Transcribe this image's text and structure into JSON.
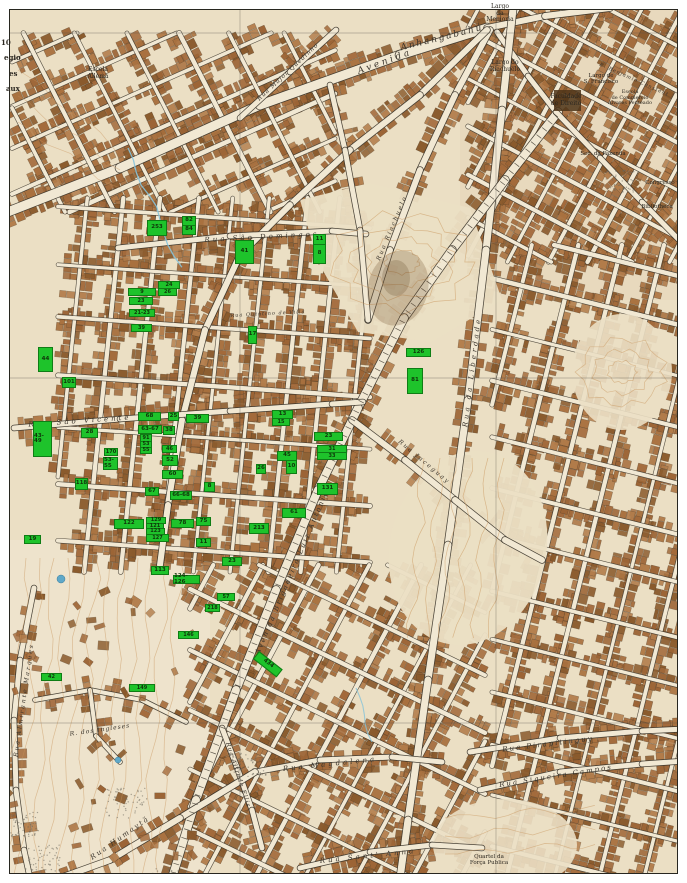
{
  "map_type": "historical-city-plan",
  "city_area": "São Paulo - Anhangabahú / Liberdade / Bexiga",
  "colors": {
    "paper": "#ebdfc4",
    "paper_light": "#f1e8d3",
    "building": "#a9713f",
    "building_dark": "#8a5a2c",
    "street_ink": "#3a342a",
    "street_fill": "#f1e8d3",
    "marker_green": "#1ec32b",
    "marker_text": "#10350a",
    "contour": "#c8935a",
    "water": "#6fb3cf",
    "label_ink": "#3a342c",
    "grid": "#55524a",
    "frame": "#27261f"
  },
  "markers": [
    {
      "t": "253",
      "x": 147,
      "y": 220,
      "w": 18,
      "h": 14
    },
    {
      "t": "82",
      "x": 182,
      "y": 216,
      "w": 12,
      "h": 8
    },
    {
      "t": "84",
      "x": 182,
      "y": 225,
      "w": 12,
      "h": 8
    },
    {
      "t": "41",
      "x": 235,
      "y": 240,
      "w": 17,
      "h": 22
    },
    {
      "t": "11",
      "x": 313,
      "y": 234,
      "w": 11,
      "h": 9
    },
    {
      "t": "8",
      "x": 313,
      "y": 244,
      "w": 11,
      "h": 18
    },
    {
      "t": "24",
      "x": 158,
      "y": 281,
      "w": 20,
      "h": 6
    },
    {
      "t": "26",
      "x": 158,
      "y": 288,
      "w": 17,
      "h": 6
    },
    {
      "t": "9",
      "x": 128,
      "y": 288,
      "w": 26,
      "h": 6
    },
    {
      "t": "23",
      "x": 129,
      "y": 297,
      "w": 22,
      "h": 6
    },
    {
      "t": "21-23",
      "x": 129,
      "y": 309,
      "w": 24,
      "h": 6
    },
    {
      "t": "39",
      "x": 131,
      "y": 324,
      "w": 19,
      "h": 6
    },
    {
      "t": "17",
      "x": 248,
      "y": 326,
      "w": 7,
      "h": 16
    },
    {
      "t": "126",
      "x": 406,
      "y": 348,
      "w": 23,
      "h": 7
    },
    {
      "t": "81",
      "x": 407,
      "y": 368,
      "w": 14,
      "h": 24
    },
    {
      "t": "44",
      "x": 38,
      "y": 347,
      "w": 13,
      "h": 23
    },
    {
      "t": "101",
      "x": 62,
      "y": 377,
      "w": 12,
      "h": 9
    },
    {
      "t": "68",
      "x": 138,
      "y": 412,
      "w": 21,
      "h": 7
    },
    {
      "t": "25",
      "x": 168,
      "y": 412,
      "w": 9,
      "h": 7
    },
    {
      "t": "39",
      "x": 186,
      "y": 414,
      "w": 21,
      "h": 7
    },
    {
      "t": "63-67",
      "x": 138,
      "y": 425,
      "w": 22,
      "h": 7
    },
    {
      "t": "38",
      "x": 163,
      "y": 426,
      "w": 10,
      "h": 7
    },
    {
      "t": "91",
      "x": 140,
      "y": 434,
      "w": 10,
      "h": 6
    },
    {
      "t": "53",
      "x": 140,
      "y": 441,
      "w": 10,
      "h": 5
    },
    {
      "t": "55",
      "x": 140,
      "y": 447,
      "w": 10,
      "h": 5
    },
    {
      "t": "46",
      "x": 162,
      "y": 445,
      "w": 13,
      "h": 6
    },
    {
      "t": "43-49",
      "x": 33,
      "y": 421,
      "w": 17,
      "h": 34
    },
    {
      "t": "28",
      "x": 81,
      "y": 428,
      "w": 15,
      "h": 8
    },
    {
      "t": "170",
      "x": 104,
      "y": 448,
      "w": 12,
      "h": 6
    },
    {
      "t": "53-55",
      "x": 103,
      "y": 457,
      "w": 13,
      "h": 11
    },
    {
      "t": "52",
      "x": 162,
      "y": 455,
      "w": 14,
      "h": 9
    },
    {
      "t": "60",
      "x": 162,
      "y": 470,
      "w": 19,
      "h": 7
    },
    {
      "t": "118",
      "x": 75,
      "y": 478,
      "w": 11,
      "h": 10
    },
    {
      "t": "67",
      "x": 145,
      "y": 487,
      "w": 12,
      "h": 7
    },
    {
      "t": "66-68",
      "x": 170,
      "y": 491,
      "w": 20,
      "h": 7
    },
    {
      "t": "8",
      "x": 204,
      "y": 482,
      "w": 9,
      "h": 8
    },
    {
      "t": "13",
      "x": 272,
      "y": 410,
      "w": 19,
      "h": 7
    },
    {
      "t": "15",
      "x": 272,
      "y": 418,
      "w": 16,
      "h": 6
    },
    {
      "t": "23",
      "x": 314,
      "y": 432,
      "w": 27,
      "h": 7
    },
    {
      "t": "31",
      "x": 317,
      "y": 445,
      "w": 28,
      "h": 6
    },
    {
      "t": "33",
      "x": 317,
      "y": 452,
      "w": 28,
      "h": 6
    },
    {
      "t": "45",
      "x": 277,
      "y": 451,
      "w": 18,
      "h": 8
    },
    {
      "t": "10",
      "x": 286,
      "y": 460,
      "w": 9,
      "h": 12
    },
    {
      "t": "26",
      "x": 256,
      "y": 464,
      "w": 8,
      "h": 8
    },
    {
      "t": "131",
      "x": 317,
      "y": 483,
      "w": 19,
      "h": 10
    },
    {
      "t": "61",
      "x": 282,
      "y": 508,
      "w": 22,
      "h": 8
    },
    {
      "t": "213",
      "x": 249,
      "y": 523,
      "w": 18,
      "h": 9
    },
    {
      "t": "122",
      "x": 114,
      "y": 519,
      "w": 28,
      "h": 8
    },
    {
      "t": "129",
      "x": 146,
      "y": 517,
      "w": 18,
      "h": 5
    },
    {
      "t": "121",
      "x": 146,
      "y": 523,
      "w": 16,
      "h": 5
    },
    {
      "t": "123",
      "x": 146,
      "y": 528,
      "w": 17,
      "h": 5
    },
    {
      "t": "78",
      "x": 171,
      "y": 519,
      "w": 21,
      "h": 7
    },
    {
      "t": "75",
      "x": 196,
      "y": 517,
      "w": 13,
      "h": 7
    },
    {
      "t": "127",
      "x": 146,
      "y": 534,
      "w": 21,
      "h": 6
    },
    {
      "t": "11",
      "x": 196,
      "y": 538,
      "w": 13,
      "h": 7
    },
    {
      "t": "19",
      "x": 24,
      "y": 535,
      "w": 15,
      "h": 7
    },
    {
      "t": "23",
      "x": 222,
      "y": 557,
      "w": 18,
      "h": 7
    },
    {
      "t": "113",
      "x": 151,
      "y": 566,
      "w": 16,
      "h": 7
    },
    {
      "t": "124-126",
      "x": 173,
      "y": 575,
      "w": 25,
      "h": 7
    },
    {
      "t": "57",
      "x": 217,
      "y": 593,
      "w": 16,
      "h": 6
    },
    {
      "t": "218",
      "x": 205,
      "y": 604,
      "w": 13,
      "h": 6
    },
    {
      "t": "146",
      "x": 178,
      "y": 631,
      "w": 19,
      "h": 6
    },
    {
      "t": "149",
      "x": 129,
      "y": 684,
      "w": 24,
      "h": 6
    },
    {
      "t": "434",
      "x": 256,
      "y": 650,
      "w": 28,
      "h": 8,
      "r": 38
    },
    {
      "t": "42",
      "x": 41,
      "y": 673,
      "w": 19,
      "h": 6
    }
  ],
  "street_labels": [
    {
      "t": "Avenida",
      "x": 385,
      "y": 62,
      "r": -20,
      "s": 9,
      "ls": 3
    },
    {
      "t": "Anhangabahú",
      "x": 442,
      "y": 38,
      "r": -14,
      "s": 9,
      "ls": 2
    },
    {
      "t": "Rua Major Quedinho",
      "x": 288,
      "y": 72,
      "r": -43,
      "s": 6,
      "ls": 1
    },
    {
      "t": "Rua Riachuelo",
      "x": 392,
      "y": 228,
      "r": -67,
      "s": 6,
      "ls": 2
    },
    {
      "t": "Rua São Domingos",
      "x": 262,
      "y": 237,
      "r": -3,
      "s": 7,
      "ls": 3
    },
    {
      "t": "Rua Quintino de Villa",
      "x": 268,
      "y": 314,
      "r": -3,
      "s": 5,
      "ls": 1
    },
    {
      "t": "Rua São Vicente",
      "x": 80,
      "y": 421,
      "r": -4,
      "s": 7,
      "ls": 3
    },
    {
      "t": "Rua da Liberdade",
      "x": 472,
      "y": 372,
      "r": -83,
      "s": 7,
      "ls": 3
    },
    {
      "t": "Avenida Brigadeiro Luiz Antonio",
      "x": 292,
      "y": 572,
      "r": -67,
      "s": 7,
      "ls": 2
    },
    {
      "t": "Rua Jaceguay",
      "x": 424,
      "y": 462,
      "r": 40,
      "s": 6,
      "ls": 2
    },
    {
      "t": "Rua Almirante Marques",
      "x": 24,
      "y": 700,
      "r": -82,
      "s": 6,
      "ls": 2
    },
    {
      "t": "R. dos Ingleses",
      "x": 100,
      "y": 730,
      "r": -8,
      "s": 6,
      "ls": 1
    },
    {
      "t": "Rua Humaytá",
      "x": 120,
      "y": 838,
      "r": -35,
      "s": 7,
      "ls": 2
    },
    {
      "t": "Rua Magdalena",
      "x": 330,
      "y": 764,
      "r": -6,
      "s": 7,
      "ls": 3
    },
    {
      "t": "Rua Sant' Anna",
      "x": 368,
      "y": 856,
      "r": -6,
      "s": 7,
      "ls": 3
    },
    {
      "t": "Rua Alfredo Ellis",
      "x": 238,
      "y": 775,
      "r": 72,
      "s": 6,
      "ls": 1
    },
    {
      "t": "Rua Pirapitinguy",
      "x": 548,
      "y": 744,
      "r": -7,
      "s": 7,
      "ls": 2
    },
    {
      "t": "Rua Siqueira Campos",
      "x": 556,
      "y": 776,
      "r": -9,
      "s": 7,
      "ls": 2
    },
    {
      "t": "R. Benjamin Constant",
      "x": 634,
      "y": 80,
      "r": 24,
      "s": 5,
      "ls": 1
    }
  ],
  "place_labels": [
    {
      "lines": [
        "Largo",
        "da",
        "Memoria"
      ],
      "x": 500,
      "y": 4,
      "s": 6
    },
    {
      "lines": [
        "Largo do",
        "Riachuelo"
      ],
      "x": 505,
      "y": 60,
      "s": 6
    },
    {
      "lines": [
        "Largo de",
        "S. Francisco"
      ],
      "x": 601,
      "y": 73,
      "s": 5.5
    },
    {
      "lines": [
        "Faculdade",
        "de Direito"
      ],
      "x": 566,
      "y": 94,
      "s": 6
    },
    {
      "lines": [
        "Escola",
        "de Commercio",
        "Alvares Penteado"
      ],
      "x": 630,
      "y": 90,
      "s": 5
    },
    {
      "lines": [
        "Sec. da Fazenda"
      ],
      "x": 603,
      "y": 151,
      "s": 5.5
    },
    {
      "lines": [
        "Congresso"
      ],
      "x": 660,
      "y": 180,
      "s": 5.5
    },
    {
      "lines": [
        "Bibliotheca"
      ],
      "x": 657,
      "y": 204,
      "s": 5.5
    },
    {
      "lines": [
        "Escola",
        "Allemã"
      ],
      "x": 98,
      "y": 67,
      "s": 6
    },
    {
      "lines": [
        "Quartel da",
        "Força Publica"
      ],
      "x": 489,
      "y": 854,
      "s": 5.5
    }
  ],
  "edge_labels": [
    {
      "t": "10",
      "x": 1,
      "y": 38
    },
    {
      "t": "egio",
      "x": 4,
      "y": 53
    },
    {
      "t": "es",
      "x": 9,
      "y": 69
    },
    {
      "t": "aux",
      "x": 6,
      "y": 84
    }
  ]
}
